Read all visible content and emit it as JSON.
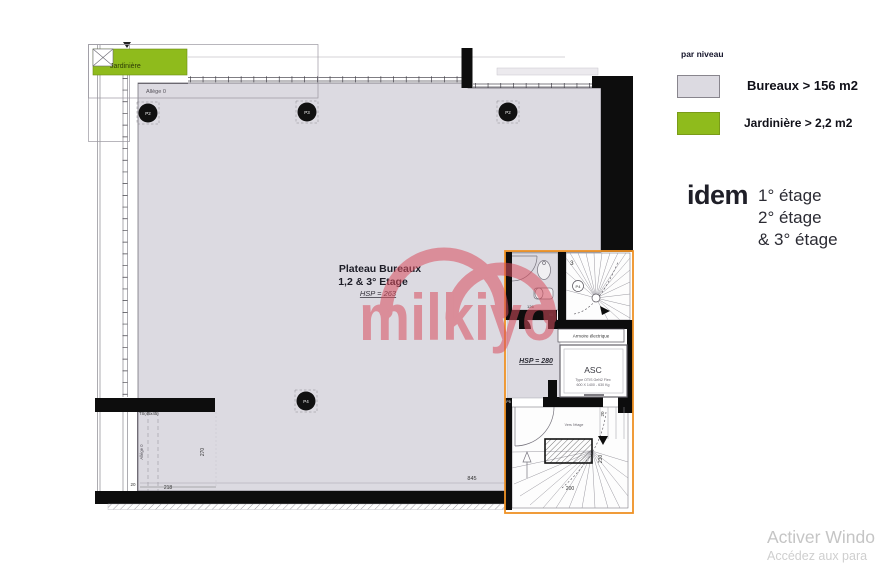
{
  "legend": {
    "title": "par niveau",
    "items": [
      {
        "label": "Bureaux > 156 m2",
        "swatch_color": "#dcdae1"
      },
      {
        "label": "Jardinière  > 2,2 m2",
        "swatch_color": "#8fbb1c"
      }
    ]
  },
  "levels": {
    "keyword": "idem",
    "lines": [
      "1° étage",
      "2° étage",
      "& 3° étage"
    ]
  },
  "activation": {
    "line1": "Activer Windo",
    "line2": "Accédez aux para"
  },
  "watermark": {
    "text": "milkiyo",
    "color": "#d94f5f"
  },
  "plan": {
    "title": {
      "line1": "Plateau Bureaux",
      "line2": "1,2 & 3° Etage",
      "line3": "HSP = 263"
    },
    "jardiniere": "Jardinière",
    "allege_top": "Allège 0",
    "allege_left": "Allège 0",
    "ts": "TS(45x45)",
    "hsp280": "HSP = 280",
    "armoire": "Armoire électrique",
    "asc": {
      "name": "ASC",
      "spec1": "Type OTIS GeN2 Flex",
      "spec2": "600 X 1400 - 630 Kg"
    },
    "stairs_upper": {
      "level": "3",
      "column": "P4"
    },
    "stairs_lower": {
      "note": "Vers l'étage"
    },
    "columns": [
      {
        "label": "P2"
      },
      {
        "label": "P3"
      },
      {
        "label": "P2"
      },
      {
        "label": "P4"
      },
      {
        "label": "P5"
      }
    ],
    "dims": {
      "total_width": "845",
      "left_width": "218",
      "left_height": "270",
      "left_small": "20",
      "stair_width": "200",
      "stair_height": "230",
      "stair_small": "20",
      "wc_width": "126",
      "wc_small": "95"
    },
    "colors": {
      "floor": "#dcdae1",
      "core_outline": "#ef9225",
      "wall": "#0d0d0d"
    }
  }
}
